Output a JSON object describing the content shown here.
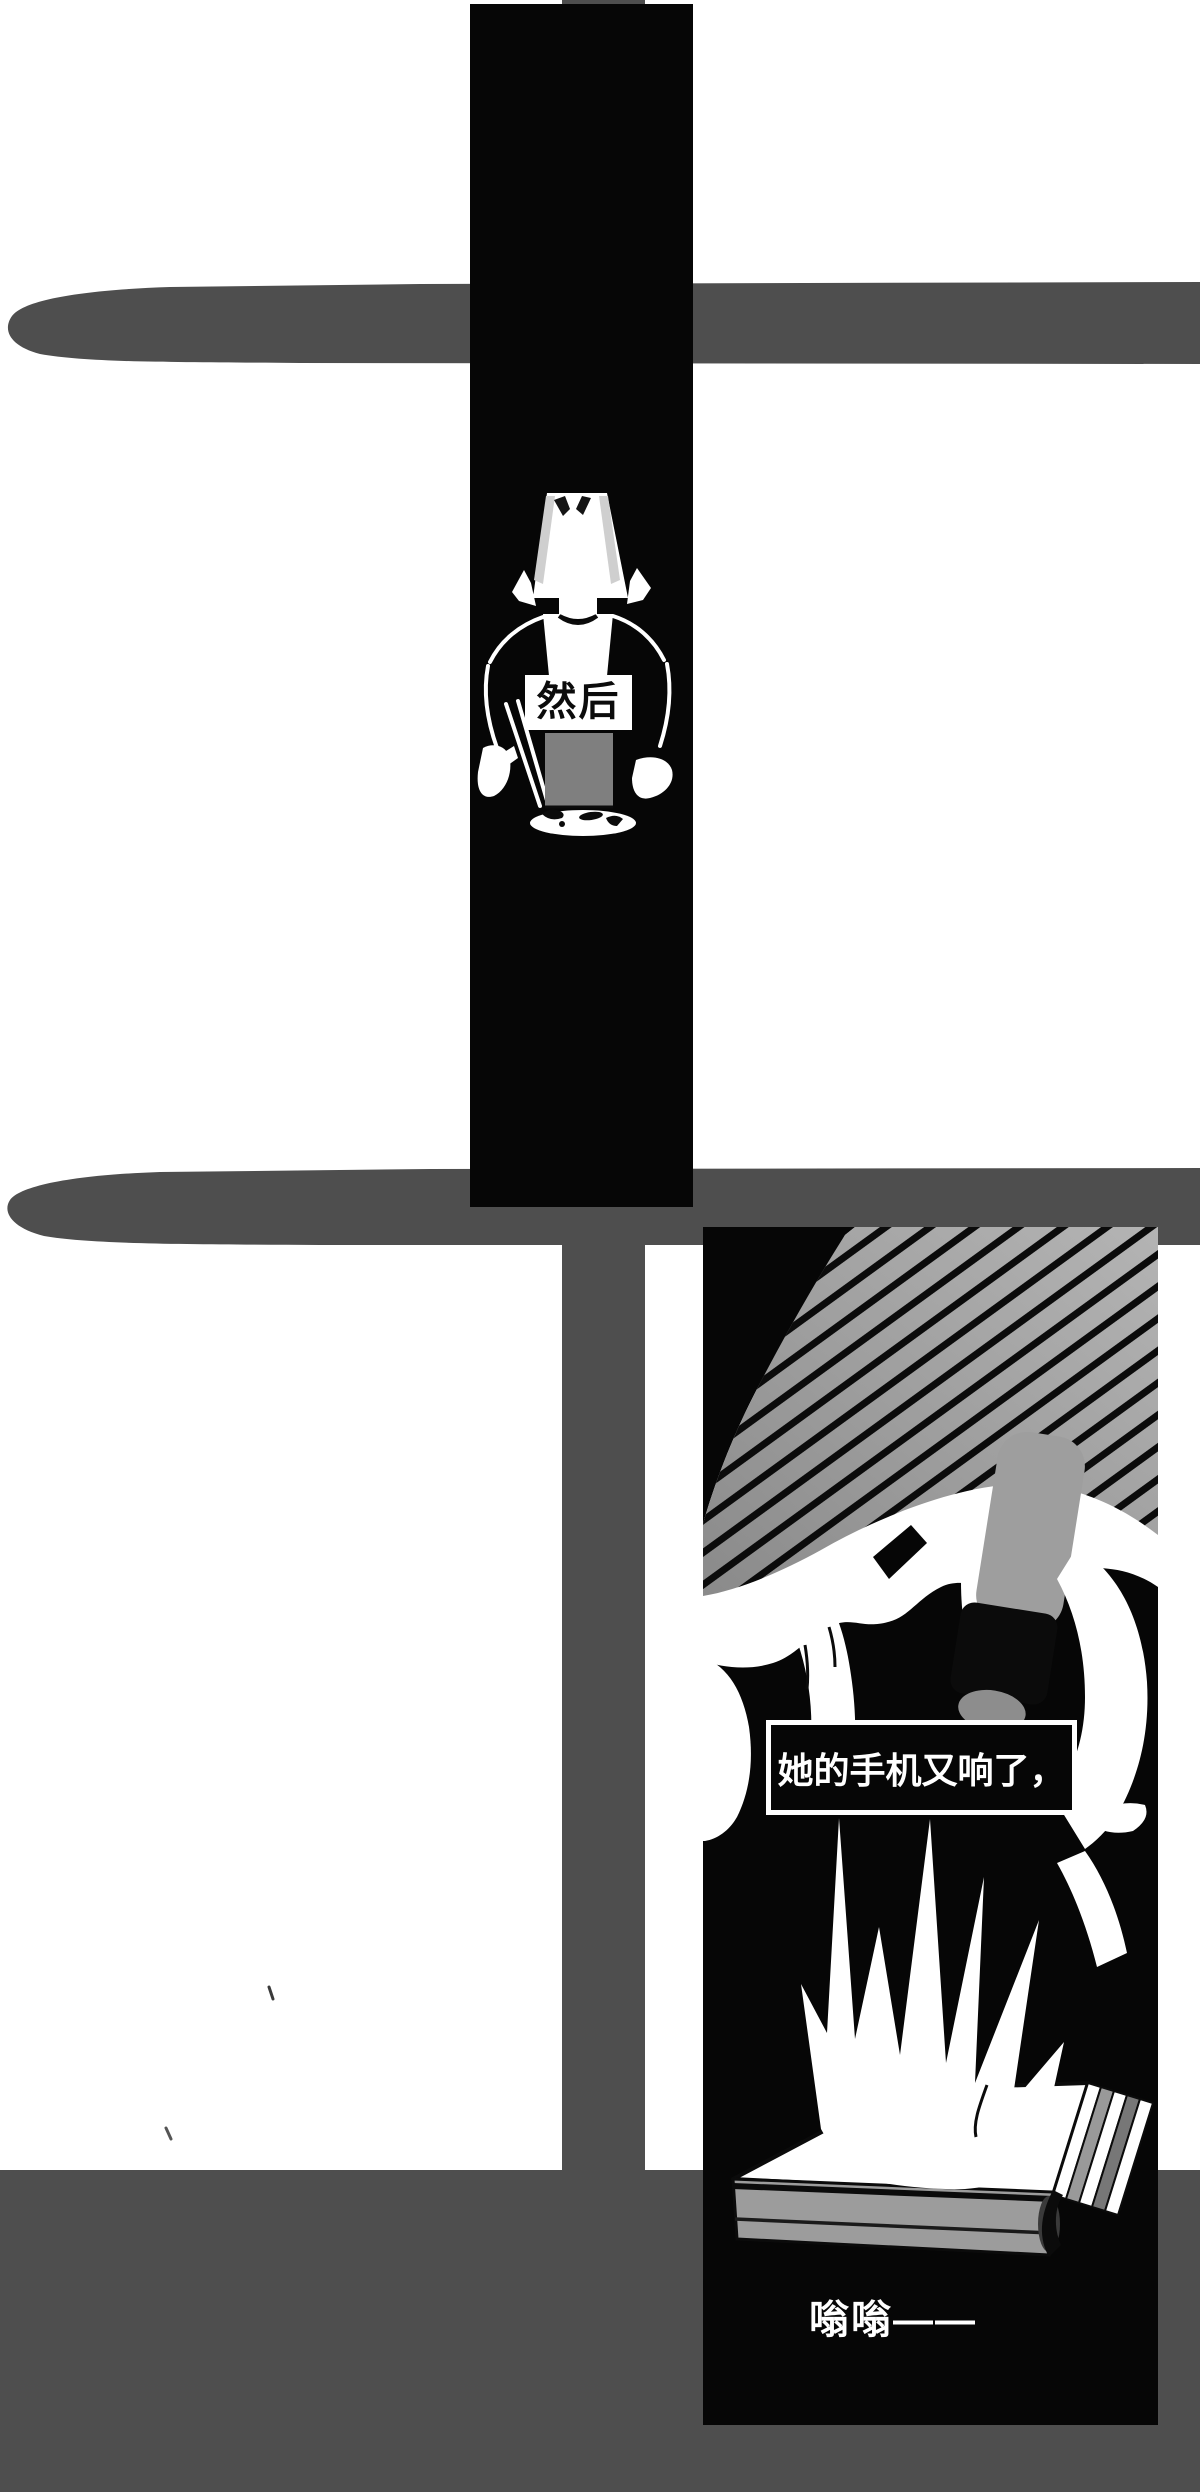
{
  "page": {
    "width": 1200,
    "height": 2492,
    "background": "#ffffff"
  },
  "colors": {
    "panel_black": "#060606",
    "beam_gray": "#4e4e4e",
    "floor_gray": "#4e4e4e",
    "wall_strip_gray": "#4e4e4e",
    "bowl_gray": "#7f7f7f",
    "book_side_gray": "#9c9c9c",
    "hand_gray_light": "#b4b4b4",
    "hand_gray_dark": "#8a8a8a",
    "finger_gray": "#9e9e9e",
    "ink_white": "#ffffff",
    "ink_black": "#0b0b0b"
  },
  "panels": {
    "panel1": {
      "caption": "然后"
    },
    "panel2": {
      "caption": "她的手机又响了，",
      "sfx": "嗡嗡——"
    }
  }
}
